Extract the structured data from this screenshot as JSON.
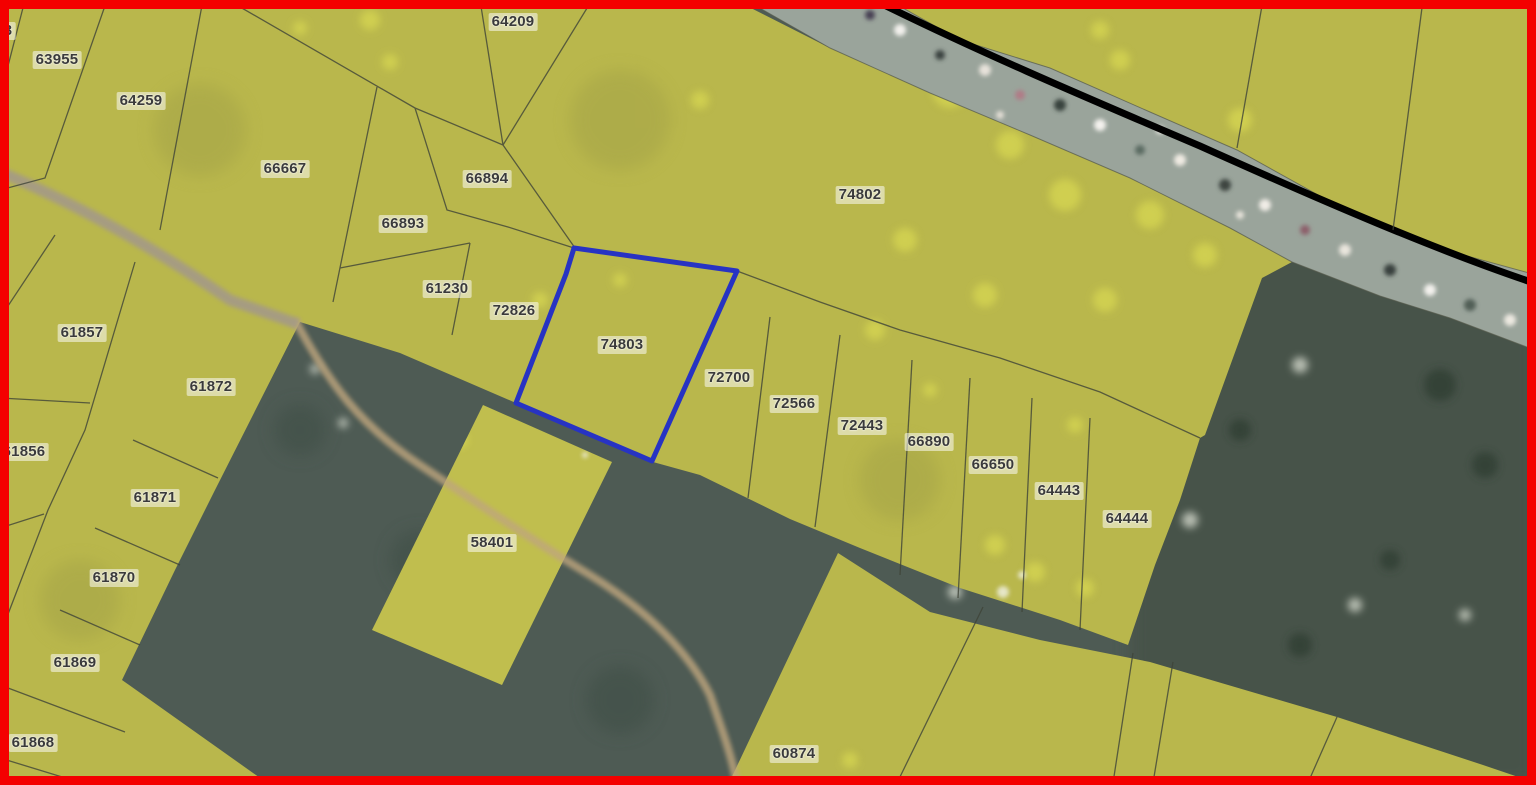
{
  "map": {
    "selected_parcel_id": "74803",
    "colors": {
      "frame": "#f40000",
      "parcel_fill": "#b9b74c",
      "selected_outline": "#2733c3",
      "label_text": "#3a3a3a",
      "ground": "#4e5b54",
      "road_line": "#000000"
    },
    "parcel_labels": [
      {
        "id": "3",
        "x": 8,
        "y": 31
      },
      {
        "id": "63955",
        "x": 57,
        "y": 60
      },
      {
        "id": "64259",
        "x": 141,
        "y": 101
      },
      {
        "id": "64209",
        "x": 513,
        "y": 22
      },
      {
        "id": "66667",
        "x": 285,
        "y": 169
      },
      {
        "id": "66894",
        "x": 487,
        "y": 179
      },
      {
        "id": "66893",
        "x": 403,
        "y": 224
      },
      {
        "id": "61230",
        "x": 447,
        "y": 289
      },
      {
        "id": "72826",
        "x": 514,
        "y": 311
      },
      {
        "id": "74802",
        "x": 860,
        "y": 195
      },
      {
        "id": "74803",
        "x": 622,
        "y": 345
      },
      {
        "id": "72700",
        "x": 729,
        "y": 378
      },
      {
        "id": "72566",
        "x": 794,
        "y": 404
      },
      {
        "id": "72443",
        "x": 862,
        "y": 426
      },
      {
        "id": "66890",
        "x": 929,
        "y": 442
      },
      {
        "id": "66650",
        "x": 993,
        "y": 465
      },
      {
        "id": "64443",
        "x": 1059,
        "y": 491
      },
      {
        "id": "64444",
        "x": 1127,
        "y": 519
      },
      {
        "id": "61857",
        "x": 82,
        "y": 333
      },
      {
        "id": "61872",
        "x": 211,
        "y": 387
      },
      {
        "id": "61856",
        "x": 24,
        "y": 452
      },
      {
        "id": "61871",
        "x": 155,
        "y": 498
      },
      {
        "id": "61870",
        "x": 114,
        "y": 578
      },
      {
        "id": "61869",
        "x": 75,
        "y": 663
      },
      {
        "id": "61868",
        "x": 33,
        "y": 743
      },
      {
        "id": "58401",
        "x": 492,
        "y": 543
      },
      {
        "id": "60874",
        "x": 794,
        "y": 754
      }
    ]
  }
}
